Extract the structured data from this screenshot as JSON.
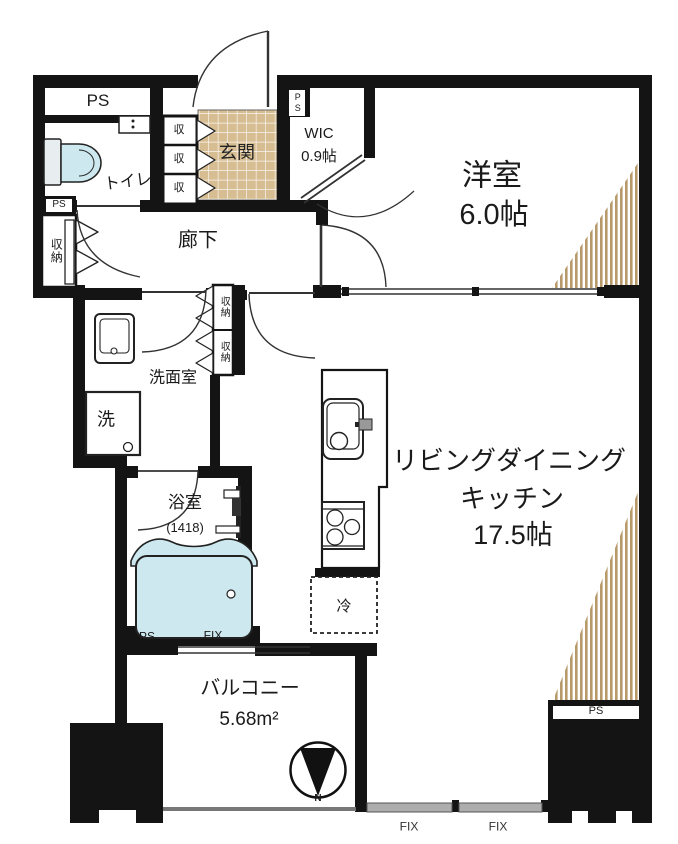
{
  "floorplan": {
    "labels": {
      "ps_top": "PS",
      "toilet": "トイレ",
      "entrance": "玄関",
      "wic_name": "WIC",
      "wic_size": "0.9帖",
      "ps_wic": "PS",
      "bedroom_name": "洋室",
      "bedroom_size": "6.0帖",
      "hallway": "廊下",
      "ps_left": "PS",
      "closet_left": "収納",
      "entry_cells": [
        "収",
        "収",
        "収"
      ],
      "hall_closet_upper": "収納",
      "hall_closet_lower": "収納",
      "washroom": "洗面室",
      "washer": "洗",
      "bathroom_name": "浴室",
      "bathroom_size": "(1418)",
      "ldk_name_line1": "リビングダイニング",
      "ldk_name_line2": "キッチン",
      "ldk_size": "17.5帖",
      "fridge": "冷",
      "ps_bath": "PS",
      "fix_bath": "FIX",
      "balcony_name": "バルコニー",
      "balcony_size": "5.68m²",
      "ps_pillar": "PS",
      "fix_left": "FIX",
      "fix_right": "FIX",
      "north": "N"
    },
    "colors": {
      "wall": "#141414",
      "tile": "#d7bd92",
      "hatch_stripe": "#b8996a",
      "fixture_blue": "#cde9ef",
      "window_gray": "#adadad"
    }
  }
}
